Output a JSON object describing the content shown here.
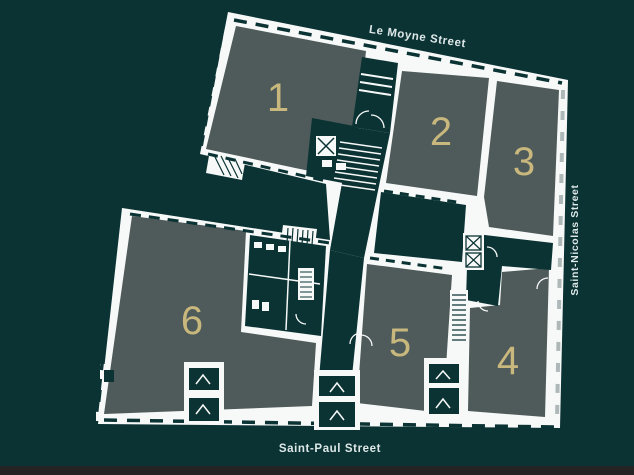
{
  "title": {
    "line1": "GROUND",
    "line2": "FLOOR"
  },
  "streets": {
    "top": "Le Moyne Street",
    "right": "Saint-Nicolas Street",
    "bottom": "Saint-Paul Street"
  },
  "units": [
    {
      "label": "1"
    },
    {
      "label": "2"
    },
    {
      "label": "3"
    },
    {
      "label": "4"
    },
    {
      "label": "5"
    },
    {
      "label": "6"
    }
  ],
  "colors": {
    "background": "#0b3334",
    "room_fill": "#4e5b5a",
    "unit_number": "#c9b87d",
    "wall": "#f7f9f8",
    "title_text": "#f0eddb",
    "street_text": "#dfe8e8",
    "bottom_bar": "#242424"
  }
}
